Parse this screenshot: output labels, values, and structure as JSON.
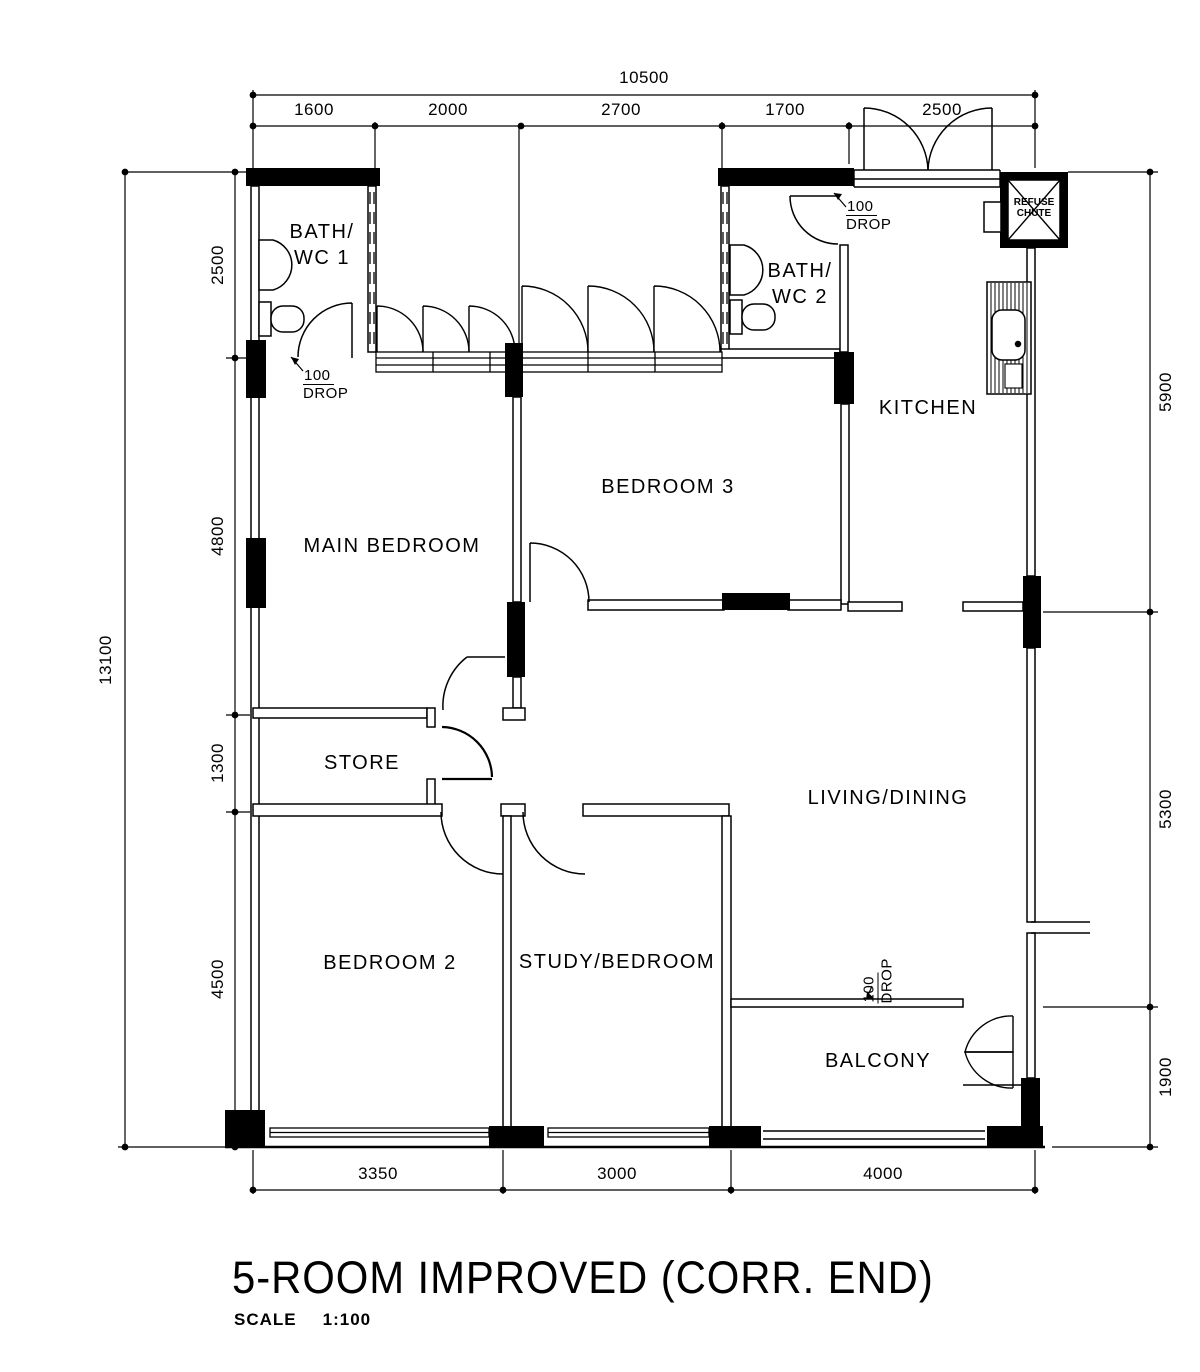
{
  "title": {
    "text": "5-ROOM IMPROVED (CORR. END)",
    "scale_label": "SCALE",
    "scale_value": "1:100"
  },
  "rooms": {
    "bath1": {
      "line1": "BATH/",
      "line2": "WC 1"
    },
    "bath2": {
      "line1": "BATH/",
      "line2": "WC 2"
    },
    "kitchen": {
      "label": "KITCHEN"
    },
    "main_bedroom": {
      "label": "MAIN BEDROOM"
    },
    "bedroom3": {
      "label": "BEDROOM 3"
    },
    "store": {
      "label": "STORE"
    },
    "living": {
      "label": "LIVING/DINING"
    },
    "bedroom2": {
      "label": "BEDROOM 2"
    },
    "study": {
      "label": "STUDY/BEDROOM"
    },
    "balcony": {
      "label": "BALCONY"
    }
  },
  "dimensions": {
    "top_overall": "10500",
    "top": [
      "1600",
      "2000",
      "2700",
      "1700",
      "2500"
    ],
    "left_overall": "13100",
    "left": [
      "2500",
      "4800",
      "1300",
      "4500"
    ],
    "right": [
      "5900",
      "5300",
      "1900"
    ],
    "bottom": [
      "3350",
      "3000",
      "4000"
    ]
  },
  "annotations": {
    "drop_bath1": {
      "value": "100",
      "label": "DROP"
    },
    "drop_kitchen": {
      "value": "100",
      "label": "DROP"
    },
    "drop_balcony": {
      "value": "100",
      "label": "DROP"
    },
    "refuse_chute": {
      "line1": "REFUSE",
      "line2": "CHUTE"
    }
  },
  "colors": {
    "ink": "#000000",
    "paper": "#ffffff"
  }
}
